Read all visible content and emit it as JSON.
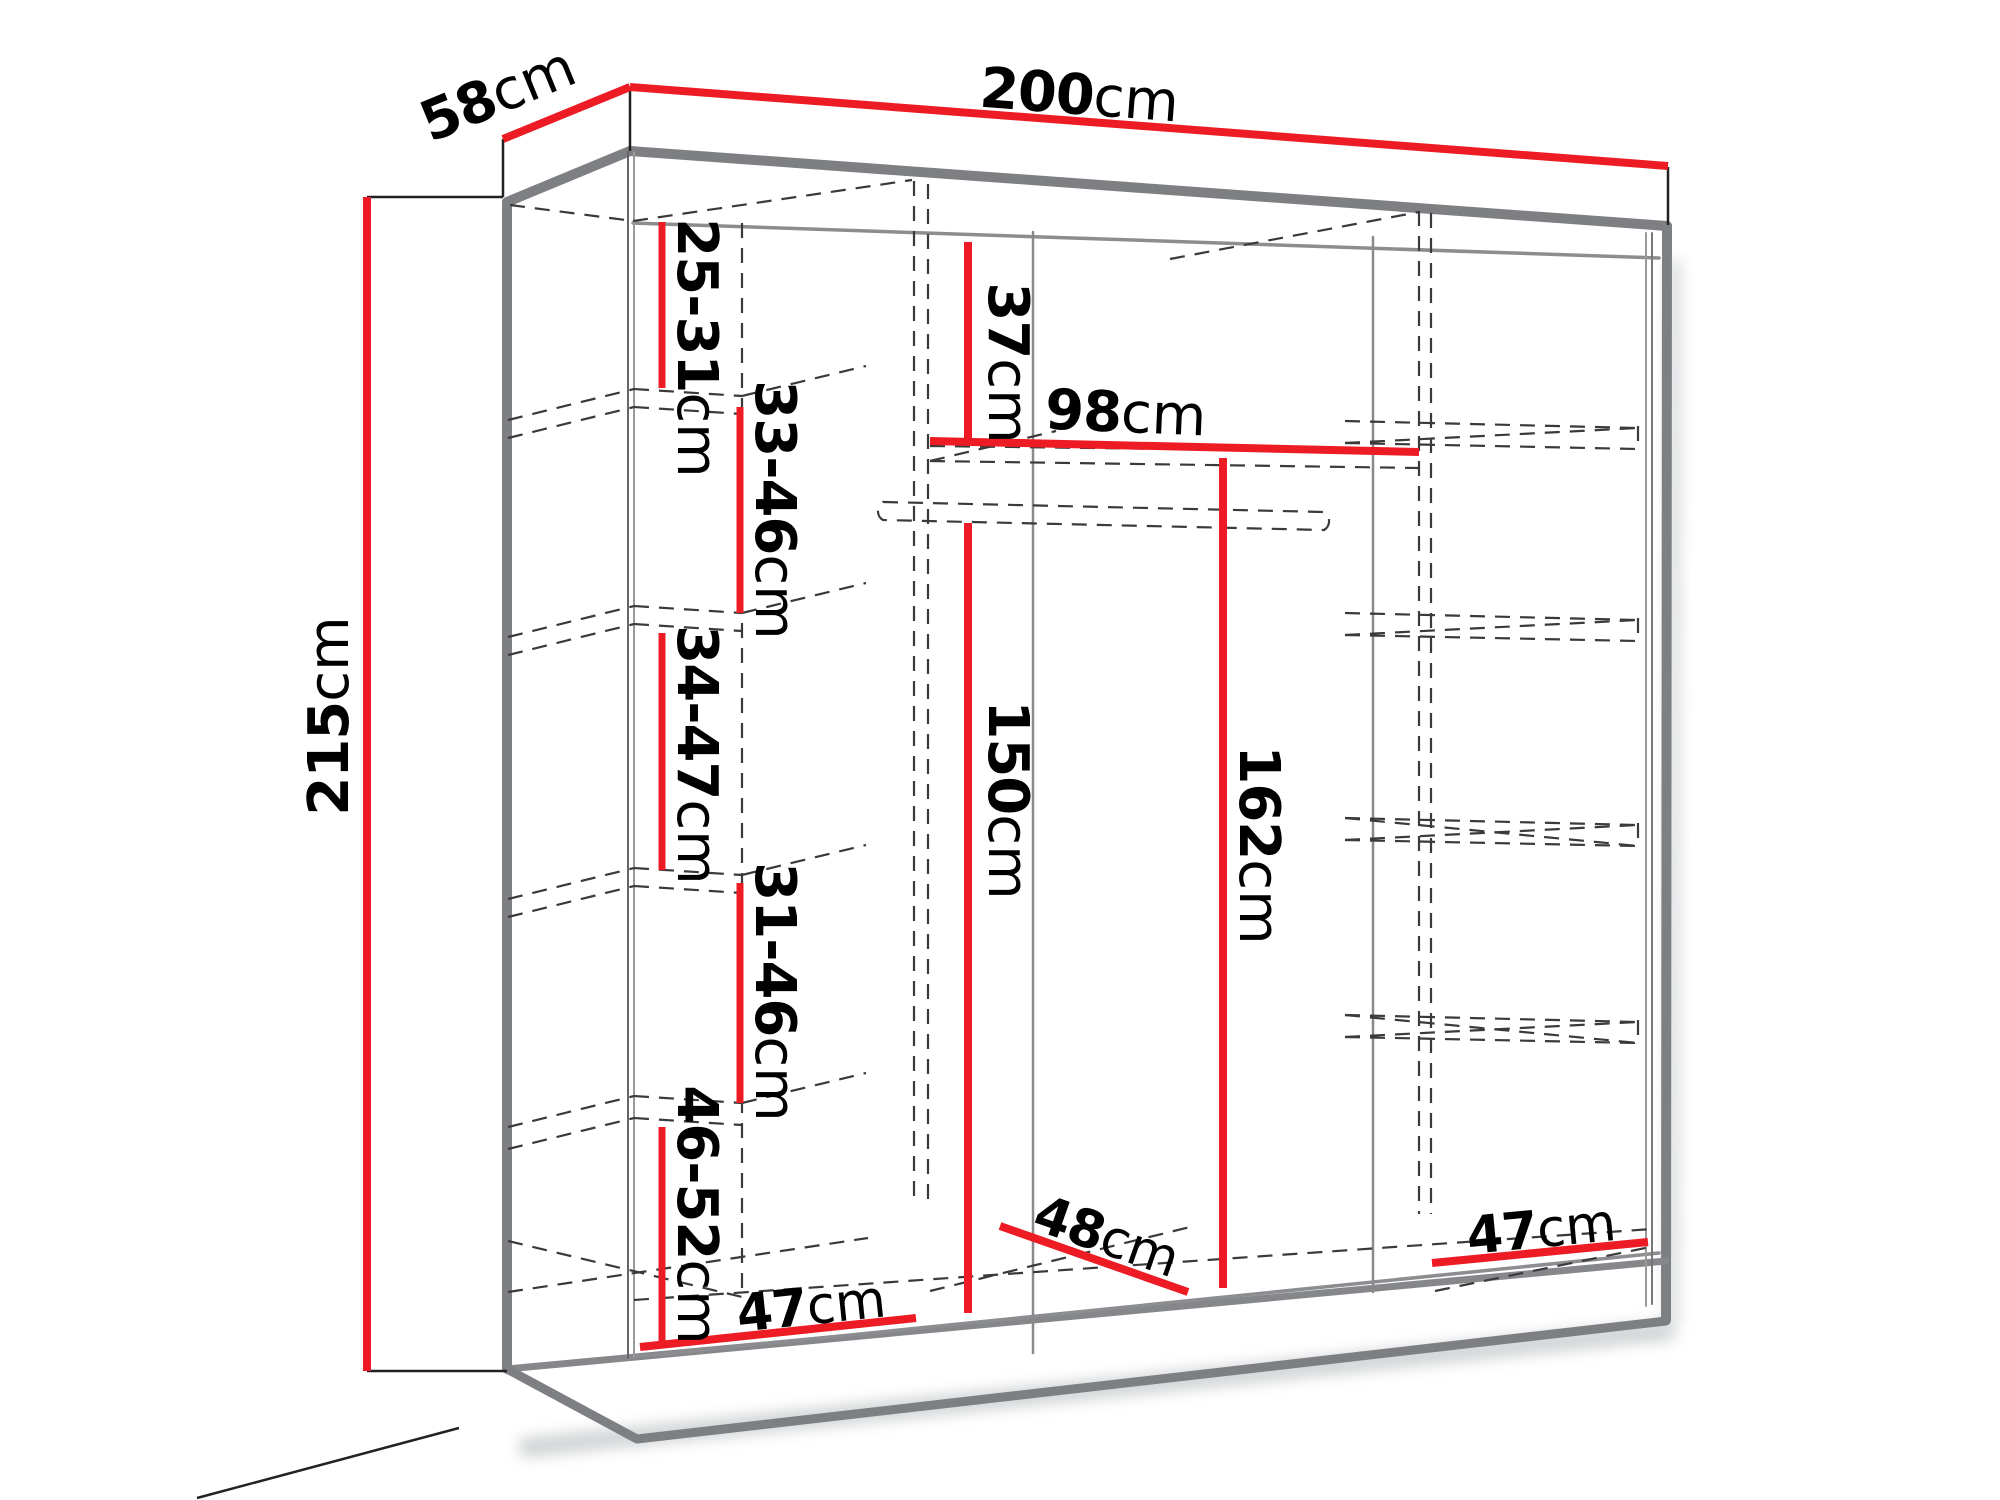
{
  "diagram": {
    "subject": "wardrobe-dimension-drawing",
    "dimensions": {
      "width": {
        "value": "200",
        "unit": "cm"
      },
      "depth": {
        "value": "58",
        "unit": "cm"
      },
      "height": {
        "value": "215",
        "unit": "cm"
      },
      "left_top_shelf_gap": {
        "value": "25-31",
        "unit": "cm"
      },
      "left_shelf_gap_2": {
        "value": "33-46",
        "unit": "cm"
      },
      "left_shelf_gap_3": {
        "value": "34-47",
        "unit": "cm"
      },
      "left_shelf_gap_4": {
        "value": "31-46",
        "unit": "cm"
      },
      "left_bottom_shelf_gap": {
        "value": "46-52",
        "unit": "cm"
      },
      "top_clearance": {
        "value": "37",
        "unit": "cm"
      },
      "rod_section_width": {
        "value": "98",
        "unit": "cm"
      },
      "hanging_height": {
        "value": "150",
        "unit": "cm"
      },
      "right_section_height": {
        "value": "162",
        "unit": "cm"
      },
      "bottom_depth": {
        "value": "48",
        "unit": "cm"
      },
      "bottom_left_width": {
        "value": "47",
        "unit": "cm"
      },
      "bottom_right_width": {
        "value": "47",
        "unit": "cm"
      }
    },
    "colors": {
      "dimension_line": "#ed1c24",
      "cabinet_edge": "#7d7f82",
      "hidden_edge": "#3a3a3a",
      "text": "#000000"
    }
  }
}
